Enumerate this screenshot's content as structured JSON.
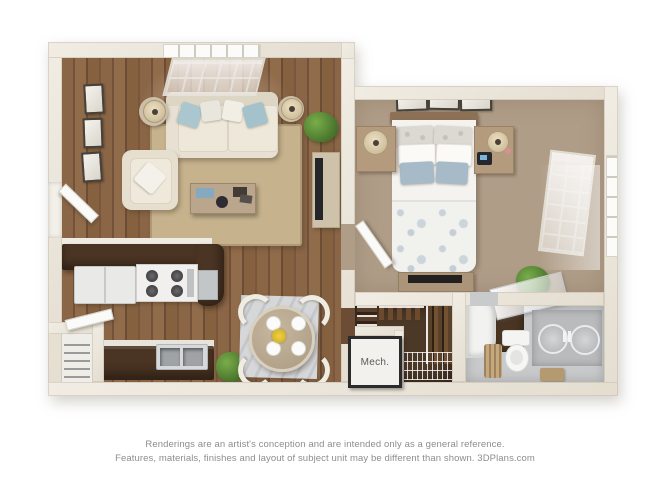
{
  "image": {
    "kind": "3d-floor-plan-rendering",
    "background": "#ffffff"
  },
  "disclaimer": {
    "line1": "Renderings are an artist's conception and are intended only as a general reference.",
    "line2": "Features, materials, finishes and layout of subject unit may be different than shown. 3DPlans.com"
  },
  "floorplan": {
    "labels": {
      "mech_room": "Mech."
    },
    "rooms": [
      "living-room",
      "kitchen",
      "dining-area",
      "bedroom",
      "walk-in-closet",
      "mechanical-closet",
      "bathroom",
      "entry-closet"
    ],
    "colors": {
      "wall_cream": "#eae4d8",
      "wood_floor": "#82603f",
      "bedroom_carpet": "#b09d88",
      "living_rug_sisal": "#c6b28d",
      "dining_rug_gray": "#d6d7d9",
      "counter_dark_brown": "#4a3423",
      "closet_floor_brown": "#4b3827",
      "bathroom_floor_gray": "#c9cacb",
      "sofa_cream": "#e8e1d3",
      "pillow_blue": "#a7c2cc",
      "bed_linen_white": "#f4f3f0",
      "plant_green": "#4a762c",
      "disclaimer_text": "#8d8d8d"
    }
  }
}
